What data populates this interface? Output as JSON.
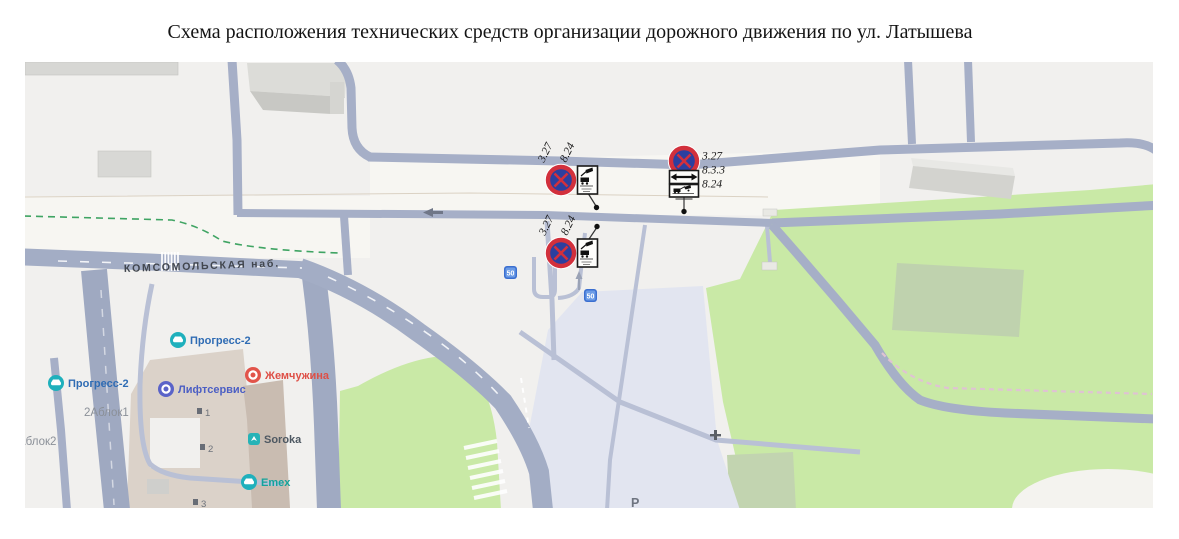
{
  "title": "Схема расположения технических средств организации дорожного движения по ул. Латышева",
  "map": {
    "street_label": "КОМСОМОЛЬСКАЯ наб.",
    "parking_label": "Р",
    "pois": {
      "progress2_top": {
        "label": "Прогресс-2",
        "icon": "car-service-icon",
        "color": "#2f6cb4"
      },
      "progress2_bottom": {
        "label": "Прогресс-2",
        "icon": "car-service-icon",
        "color": "#2f6cb4"
      },
      "liftservice": {
        "label": "Лифтсервис",
        "icon": "ring-icon",
        "color": "#4c5fc4"
      },
      "zhemchuzhina": {
        "label": "Жемчужина",
        "icon": "ring-icon",
        "color": "#de4f46"
      },
      "soroka": {
        "label": "Soroka",
        "icon": "bird-icon",
        "color": "#4e5862"
      },
      "emex": {
        "label": "Emex",
        "icon": "car-service-icon",
        "color": "#13a39b"
      }
    },
    "addresses": {
      "block1": "2Аблок1",
      "block2": "Аблок2"
    },
    "house_numbers": {
      "m1": "1",
      "m2": "2",
      "m3": "3"
    },
    "speed_badges": {
      "b1": "50",
      "b2": "50"
    },
    "signs": {
      "west_north": {
        "sign_code": "3.27",
        "plate_code": "8.24",
        "label_1": "3.27",
        "label_2": "8.24"
      },
      "west_south": {
        "sign_code": "3.27",
        "plate_code": "8.24",
        "label_1": "3.27",
        "label_2": "8.24"
      },
      "east": {
        "sign_code": "3.27",
        "plate_code_1": "8.3.3",
        "plate_code_2": "8.24",
        "label_1": "3.27",
        "label_2": "8.3.3",
        "label_3": "8.24"
      }
    },
    "colors": {
      "background": "#f1f0ee",
      "road_major": "#a6afc7",
      "road_minor": "#b9c0d5",
      "green_area": "#c9e9a6",
      "parking_area": "#e2e5f0",
      "building_gray": "#d8d8d5",
      "building_tan": "#dcd2c9",
      "sign_blue": "#2c3f9f",
      "sign_red": "#d2303c",
      "green_dash": "#3fa463",
      "pink_dash": "#dfc3d3"
    }
  }
}
